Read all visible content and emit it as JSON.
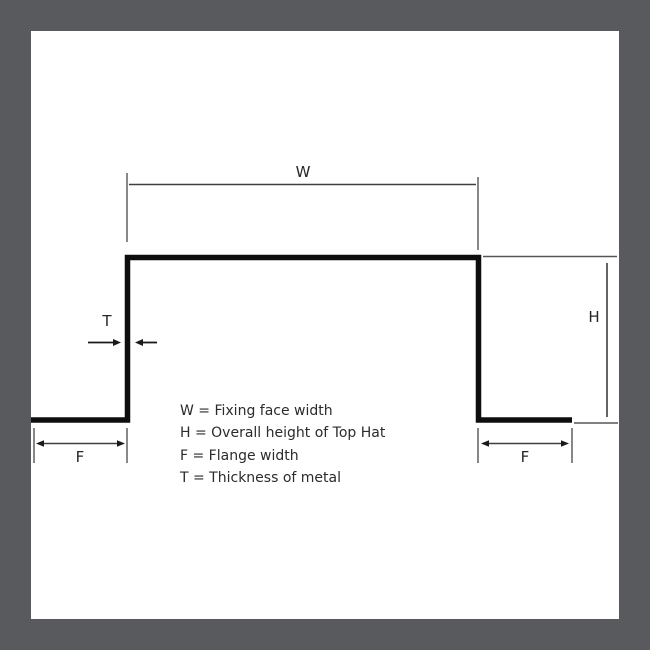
{
  "frame": {
    "border_color": "#595a5e",
    "panel_color": "#ffffff"
  },
  "diagram": {
    "title": "Top Hat profile cross-section",
    "labels": {
      "width": "W",
      "height": "H",
      "flange_left": "F",
      "flange_right": "F",
      "thickness": "T"
    },
    "legend": [
      "W = Fixing face width",
      "H = Overall height of Top Hat",
      "F = Flange width",
      "T = Thickness of metal"
    ],
    "colors": {
      "profile": "#0e0e0e",
      "dimension_lines": "#3f3f3f",
      "label_text": "#262626"
    }
  }
}
